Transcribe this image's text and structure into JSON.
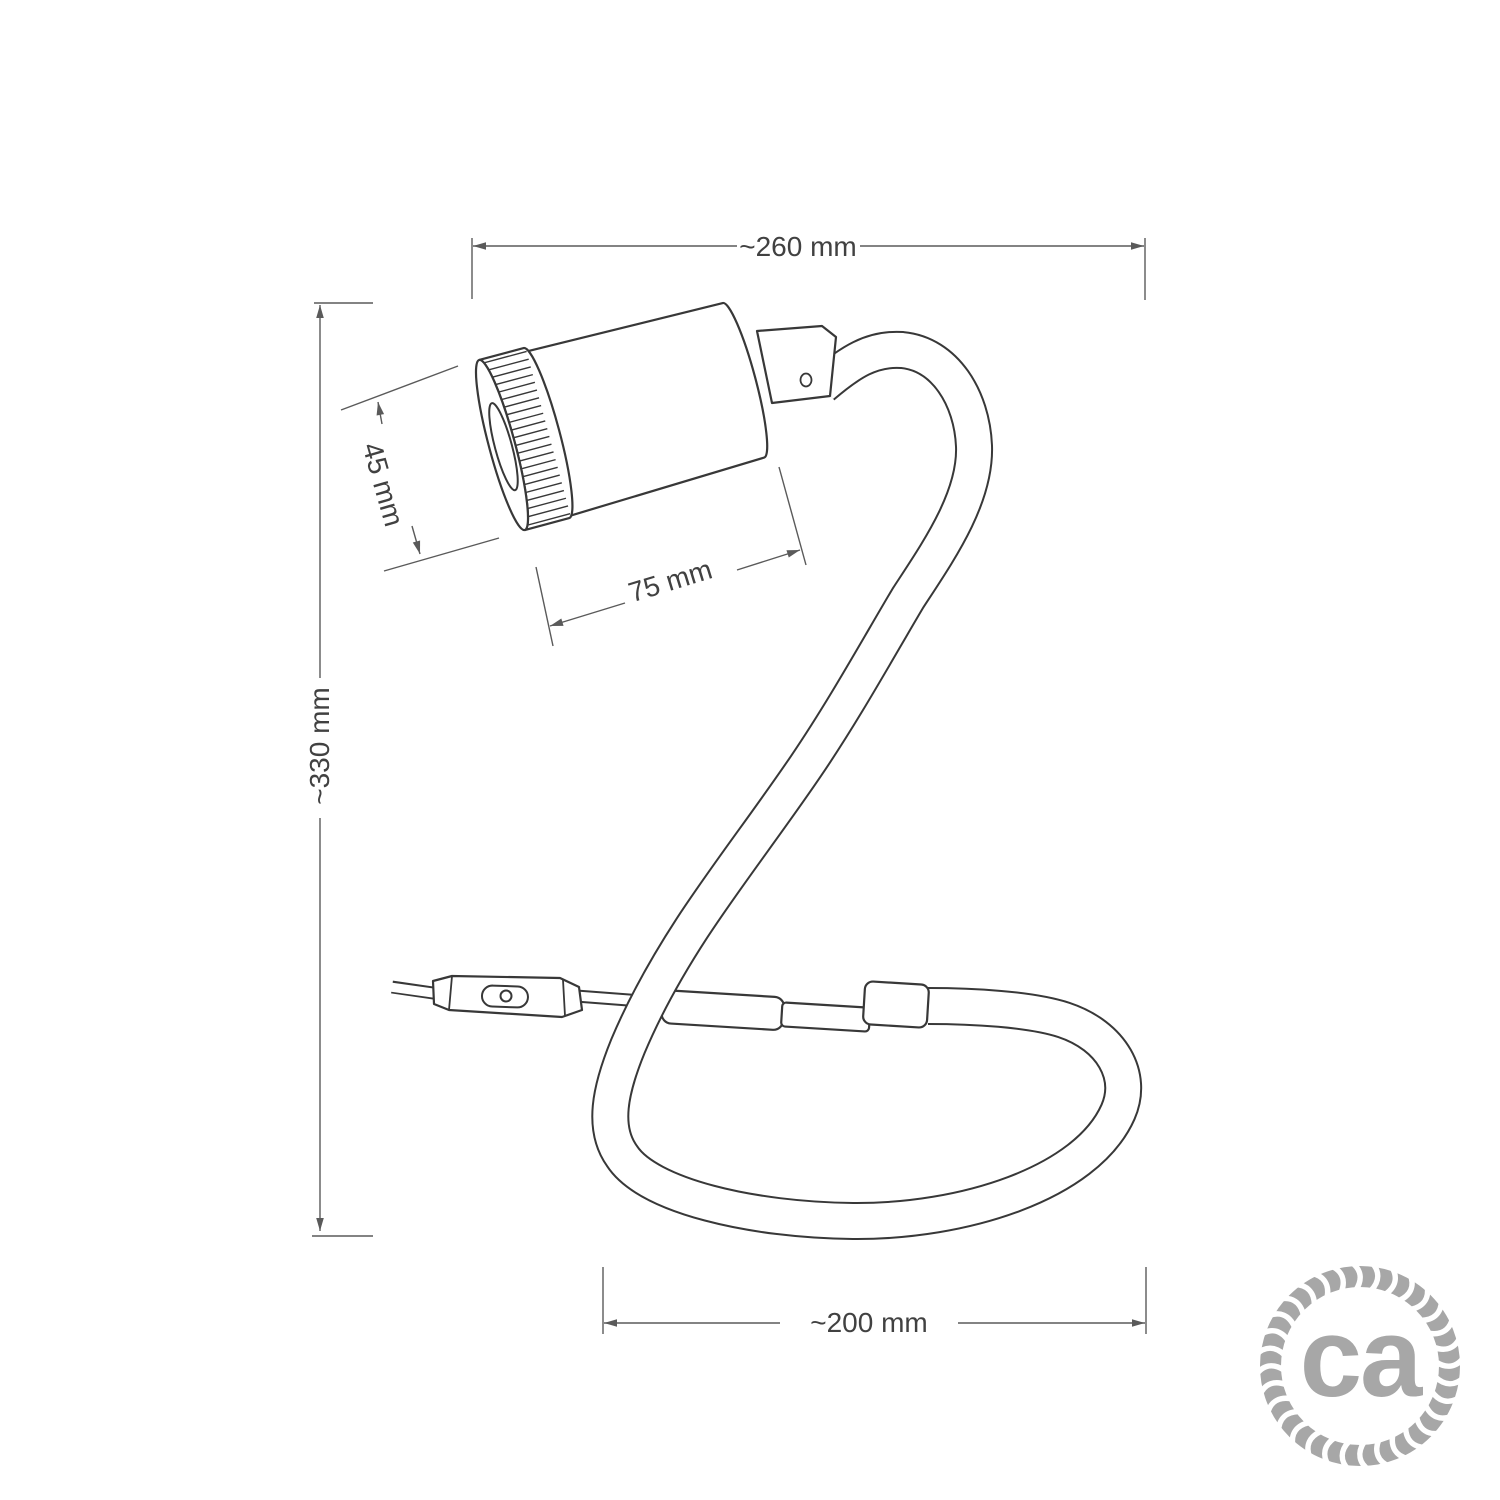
{
  "diagram": {
    "type": "product-dimension-drawing",
    "product": "flexible gooseneck table lamp with spotlight, inline switch and looped cable base",
    "dimensions": {
      "overall_width": {
        "label": "~260 mm"
      },
      "overall_height": {
        "label": "~330 mm"
      },
      "spot_diameter": {
        "label": "45 mm"
      },
      "spot_length": {
        "label": "75 mm"
      },
      "base_loop_width": {
        "label": "~200 mm"
      }
    },
    "logo": {
      "text": "ca"
    },
    "colors": {
      "background": "#ffffff",
      "object_line": "#383838",
      "dimension_line": "#5a5a5a",
      "dimension_text": "#414141",
      "logo_gray": "#a7a7a7"
    }
  }
}
